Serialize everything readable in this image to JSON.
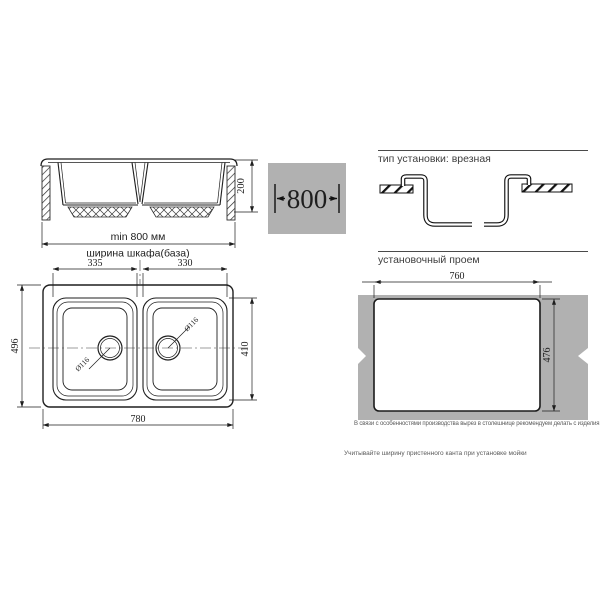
{
  "side_view": {
    "height_dim": "200",
    "min_width": "min 800 мм",
    "caption": "ширина шкафа(база)"
  },
  "badge": {
    "width": "800"
  },
  "sections": {
    "install_type": "тип установки: врезная",
    "cutout": "установочный проем"
  },
  "plan": {
    "left_bowl_width": "335",
    "right_bowl_width": "330",
    "overall_depth": "496",
    "bowl_depth": "410",
    "overall_width": "780",
    "drain_left": "Ø116",
    "drain_right": "Ø116"
  },
  "cutout": {
    "width": "760",
    "depth": "476"
  },
  "notes": {
    "production": "В связи с особенностями производства вырез в столешнице рекомендуем делать с изделия.",
    "edge": "Учитывайте ширину пристенного канта при установке мойки"
  },
  "colors": {
    "panel_gray": "#b1b1b1",
    "line": "#222222"
  }
}
